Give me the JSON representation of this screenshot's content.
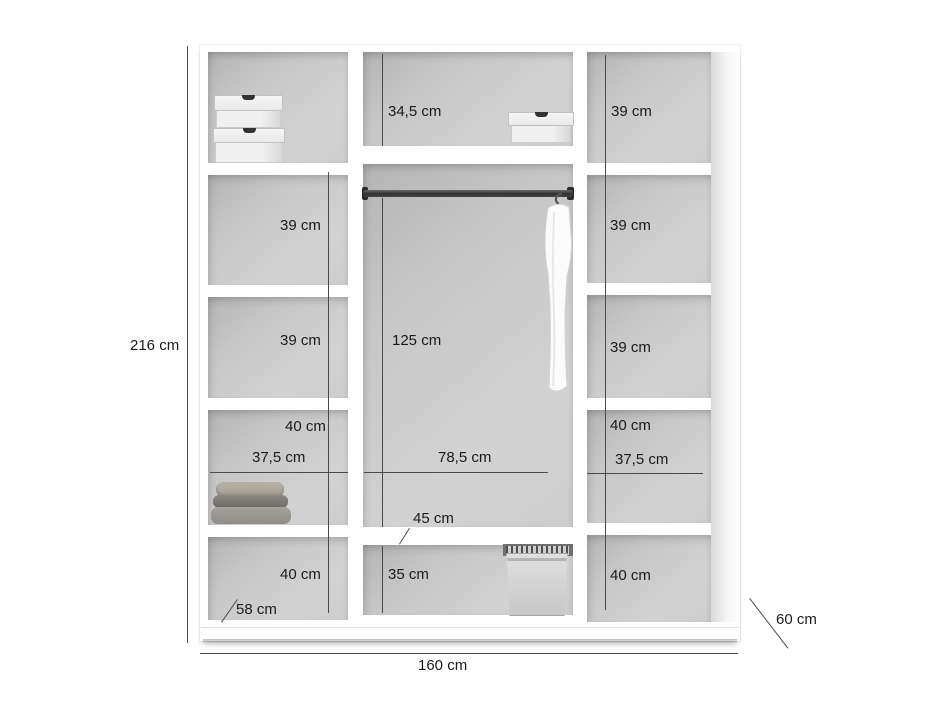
{
  "title": "Wardrobe interior dimensions diagram",
  "unit": "cm",
  "colors": {
    "background": "#ffffff",
    "cavity_grey": "#cbcbcb",
    "dimension_line": "#4a4a4a",
    "text": "#1b1b1b",
    "rail_dark": "#303030"
  },
  "overall": {
    "height": "216 cm",
    "width": "160 cm",
    "depth": "60 cm",
    "bottom_depth": "58 cm"
  },
  "left_column": {
    "shelf_2": "39 cm",
    "shelf_3": "39 cm",
    "shelf_4": "40 cm",
    "inner_width": "37,5 cm",
    "shelf_5": "40 cm"
  },
  "middle_section": {
    "top_compartment": "34,5 cm",
    "hanging_space": "125 cm",
    "inner_width": "78,5 cm",
    "shelf_depth": "45 cm",
    "bottom_compartment": "35 cm"
  },
  "right_column": {
    "shelf_1": "39 cm",
    "shelf_2": "39 cm",
    "shelf_3": "39 cm",
    "shelf_4": "40 cm",
    "inner_width": "37,5 cm",
    "shelf_5": "40 cm"
  }
}
